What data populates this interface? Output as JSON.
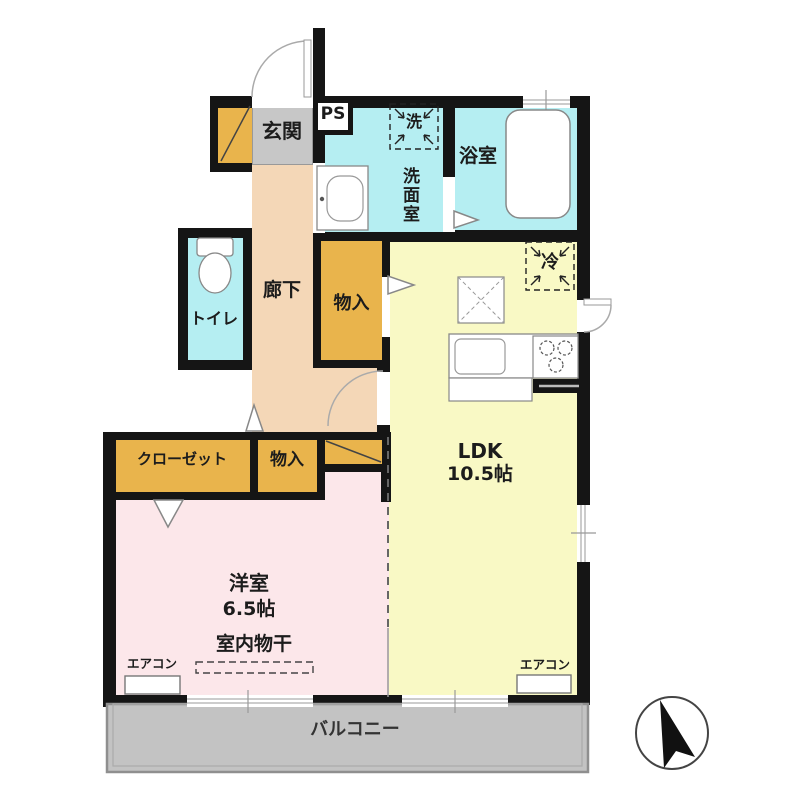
{
  "plan_type": "floorplan",
  "rooms": {
    "genkan": {
      "label": "玄関"
    },
    "ps": {
      "label": "PS"
    },
    "washroom": {
      "label": "洗面室",
      "washer_label": "洗"
    },
    "bathroom": {
      "label": "浴室"
    },
    "toilet": {
      "label": "トイレ"
    },
    "hallway": {
      "label": "廊下"
    },
    "hall_storage": {
      "label": "物入"
    },
    "fridge": {
      "label": "冷"
    },
    "ldk": {
      "label": "LDK",
      "size": "10.5帖"
    },
    "closet": {
      "label": "クローゼット"
    },
    "bedroom_storage": {
      "label": "物入"
    },
    "bedroom": {
      "label": "洋室",
      "size": "6.5帖",
      "drying_label": "室内物干"
    },
    "aircon": {
      "label": "エアコン"
    },
    "balcony": {
      "label": "バルコニー"
    }
  },
  "compass": {
    "direction": "north-up"
  },
  "colors": {
    "wall": "#151515",
    "water_rooms": "#b5eef2",
    "storage_orange": "#e9b44c",
    "hallway_tan": "#f4d7b7",
    "ldk_yellow": "#f9f9c5",
    "bedroom_pink": "#fce7ea",
    "genkan_gray": "#c7c7c7",
    "balcony_gray": "#c3c3c3"
  }
}
